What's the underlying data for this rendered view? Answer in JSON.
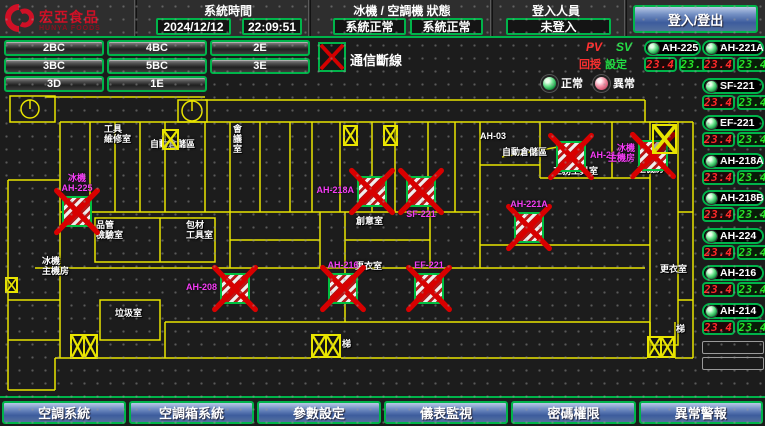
{
  "header": {
    "brand": {
      "name": "宏亞食品",
      "name_en": "HUNYA FOODS"
    },
    "system_time": {
      "label": "系統時間",
      "date": "2024/12/12",
      "time": "22:09:51"
    },
    "machine_status": {
      "label": "冰機 / 空調機 狀態",
      "chiller_status": "系統正常",
      "ac_status": "系統正常"
    },
    "login": {
      "label": "登入人員",
      "user": "未登入",
      "button_label": "登入/登出"
    }
  },
  "floor_buttons": [
    "2BC",
    "4BC",
    "2E",
    "3BC",
    "5BC",
    "3E",
    "3D",
    "1E"
  ],
  "comm_status": {
    "label": "通信斷線"
  },
  "legend": {
    "normal": "正常",
    "abnormal": "異常"
  },
  "pvsv": {
    "pv": "PV",
    "sv": "SV",
    "pv_name": "回授",
    "sv_name": "設定"
  },
  "devices": [
    {
      "name": "AH-225",
      "pv": "23.4",
      "sv": "23.4",
      "status": "normal"
    },
    {
      "name": "AH-221A",
      "pv": "23.4",
      "sv": "23.4",
      "status": "normal"
    },
    {
      "name": "SF-221",
      "pv": "23.4",
      "sv": "23.4",
      "status": "normal"
    },
    {
      "name": "EF-221",
      "pv": "23.4",
      "sv": "23.4",
      "status": "normal"
    },
    {
      "name": "AH-218A",
      "pv": "23.4",
      "sv": "23.4",
      "status": "normal"
    },
    {
      "name": "AH-218B",
      "pv": "23.4",
      "sv": "23.4",
      "status": "normal"
    },
    {
      "name": "AH-224",
      "pv": "23.4",
      "sv": "23.4",
      "status": "normal"
    },
    {
      "name": "AH-216",
      "pv": "23.4",
      "sv": "23.4",
      "status": "normal"
    },
    {
      "name": "AH-214",
      "pv": "23.4",
      "sv": "23.4",
      "status": "normal"
    }
  ],
  "empty_slots": 2,
  "floorplan": {
    "units": [
      {
        "x": 62,
        "y": 196,
        "label_lines": [
          "冰機",
          "AH-225"
        ],
        "label_pos": "above"
      },
      {
        "x": 357,
        "y": 176,
        "label_lines": [
          "AH-218A"
        ],
        "label_pos": "left"
      },
      {
        "x": 406,
        "y": 176,
        "label_lines": [
          "SF-221"
        ],
        "label_pos": "below"
      },
      {
        "x": 514,
        "y": 212,
        "label_lines": [
          "AH-221A"
        ],
        "label_pos": "above"
      },
      {
        "x": 556,
        "y": 141,
        "label_lines": [
          "AH-214"
        ],
        "label_pos": "right"
      },
      {
        "x": 638,
        "y": 140,
        "label_lines": [
          "冰機",
          "主機房"
        ],
        "label_pos": "left"
      },
      {
        "x": 220,
        "y": 273,
        "label_lines": [
          "AH-208"
        ],
        "label_pos": "left"
      },
      {
        "x": 328,
        "y": 273,
        "label_lines": [
          "AH-216"
        ],
        "label_pos": "above"
      },
      {
        "x": 414,
        "y": 273,
        "label_lines": [
          "EF-221"
        ],
        "label_pos": "above"
      }
    ],
    "room_labels": [
      {
        "x": 104,
        "y": 124,
        "lines": [
          "工具",
          "維修室"
        ]
      },
      {
        "x": 150,
        "y": 139,
        "lines": [
          "自動倉儲區"
        ]
      },
      {
        "x": 233,
        "y": 124,
        "lines": [
          "會",
          "議",
          "室"
        ]
      },
      {
        "x": 480,
        "y": 131,
        "lines": [
          "AH-03"
        ]
      },
      {
        "x": 502,
        "y": 147,
        "lines": [
          "自動倉儲區"
        ]
      },
      {
        "x": 553,
        "y": 166,
        "lines": [
          "工務工具室"
        ]
      },
      {
        "x": 637,
        "y": 164,
        "lines": [
          "主機房"
        ]
      },
      {
        "x": 96,
        "y": 220,
        "lines": [
          "品管",
          "檢驗室"
        ]
      },
      {
        "x": 186,
        "y": 220,
        "lines": [
          "包材",
          "工具室"
        ]
      },
      {
        "x": 42,
        "y": 256,
        "lines": [
          "冰機",
          "主機房"
        ]
      },
      {
        "x": 115,
        "y": 308,
        "lines": [
          "垃圾室"
        ]
      },
      {
        "x": 356,
        "y": 216,
        "lines": [
          "創意室"
        ]
      },
      {
        "x": 355,
        "y": 261,
        "lines": [
          "更衣室"
        ]
      },
      {
        "x": 660,
        "y": 264,
        "lines": [
          "更衣室"
        ]
      },
      {
        "x": 676,
        "y": 324,
        "lines": [
          "梯"
        ]
      },
      {
        "x": 342,
        "y": 339,
        "lines": [
          "梯"
        ]
      }
    ],
    "stairs": [
      {
        "x": 70,
        "y": 334,
        "w": 28,
        "h": 25,
        "cells": 2
      },
      {
        "x": 311,
        "y": 334,
        "w": 30,
        "h": 24,
        "cells": 2
      },
      {
        "x": 647,
        "y": 336,
        "w": 28,
        "h": 22,
        "cells": 2
      },
      {
        "x": 5,
        "y": 277,
        "w": 13,
        "h": 16,
        "cells": 1
      },
      {
        "x": 343,
        "y": 125,
        "w": 15,
        "h": 21,
        "cells": 1
      },
      {
        "x": 383,
        "y": 125,
        "w": 15,
        "h": 21,
        "cells": 1
      },
      {
        "x": 162,
        "y": 129,
        "w": 17,
        "h": 21,
        "cells": 1
      },
      {
        "x": 652,
        "y": 124,
        "w": 25,
        "h": 30,
        "cells": 1
      }
    ]
  },
  "footer_buttons": [
    "空調系統",
    "空調箱系統",
    "參數設定",
    "儀表監視",
    "密碼權限",
    "異常警報"
  ]
}
